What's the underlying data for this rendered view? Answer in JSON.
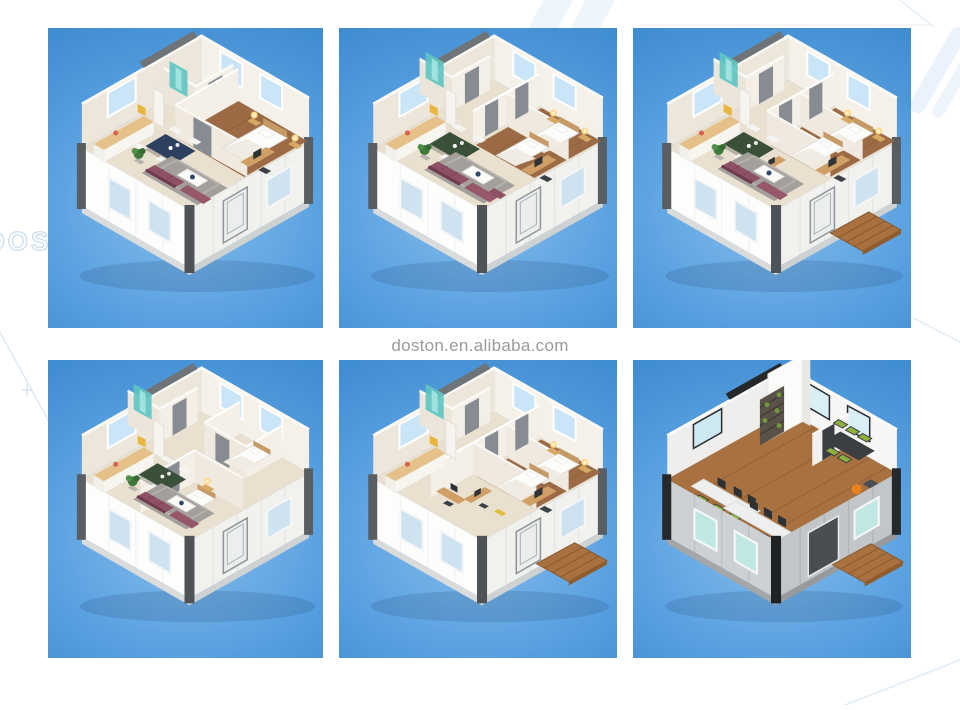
{
  "watermark": {
    "center_text": "doston.en.alibaba.com",
    "brand_text": "DOSTON",
    "text_color": "#9a9a9a"
  },
  "grid": {
    "rows": 2,
    "columns": 3,
    "panel_count": 6
  },
  "panels": [
    {
      "id": 1,
      "alt": "3D isometric floor plan - expandable container house with one bedroom, bathroom with teal shower, kitchen, dining table and living room with maroon sofa"
    },
    {
      "id": 2,
      "alt": "3D isometric floor plan - container house with two bedrooms, bathroom, kitchen and open living room with sofa set"
    },
    {
      "id": 3,
      "alt": "3D isometric floor plan - container house with three rooms, desks, living area and wooden entry deck"
    },
    {
      "id": 4,
      "alt": "3D isometric floor plan - container house with two separated bedrooms and open living area"
    },
    {
      "id": 5,
      "alt": "3D isometric floor plan - container house with bedrooms, study rooms with desks and wooden entry deck"
    },
    {
      "id": 6,
      "alt": "3D cutaway render - container office with workstations, green chairs, shelving with plants, meeting table and wooden deck"
    }
  ],
  "colors": {
    "page_background": "#ffffff",
    "sky_blue_dark": "#2f7fc4",
    "sky_blue_light": "#85bdee",
    "wall_cream": "#f0eadf",
    "floor_beige": "#e9e0cf",
    "wood_brown": "#9c6b45",
    "sofa_maroon": "#8e5064",
    "shower_teal": "#5fc6c2",
    "deck_wood": "#a9713f",
    "office_green": "#8fb03a",
    "office_orange": "#e8821e"
  }
}
